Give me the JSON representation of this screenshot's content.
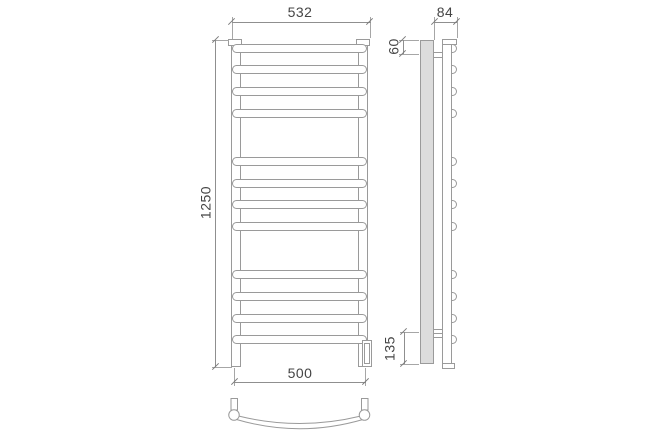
{
  "drawing": {
    "description": "ladder towel rail technical drawing, front view, side view and top view of curved bar",
    "rung_count": 12
  },
  "dimensions": {
    "overall_width": "532",
    "overall_height": "1250",
    "bar_span": "500",
    "depth": "84",
    "top_mount_offset": "60",
    "bottom_mount_offset": "135"
  },
  "colors": {
    "line": "#9a9a9a",
    "dimension_line": "#8f8f8f",
    "text": "#454545",
    "stand_fill": "#dcdcdc",
    "background": "#ffffff"
  }
}
